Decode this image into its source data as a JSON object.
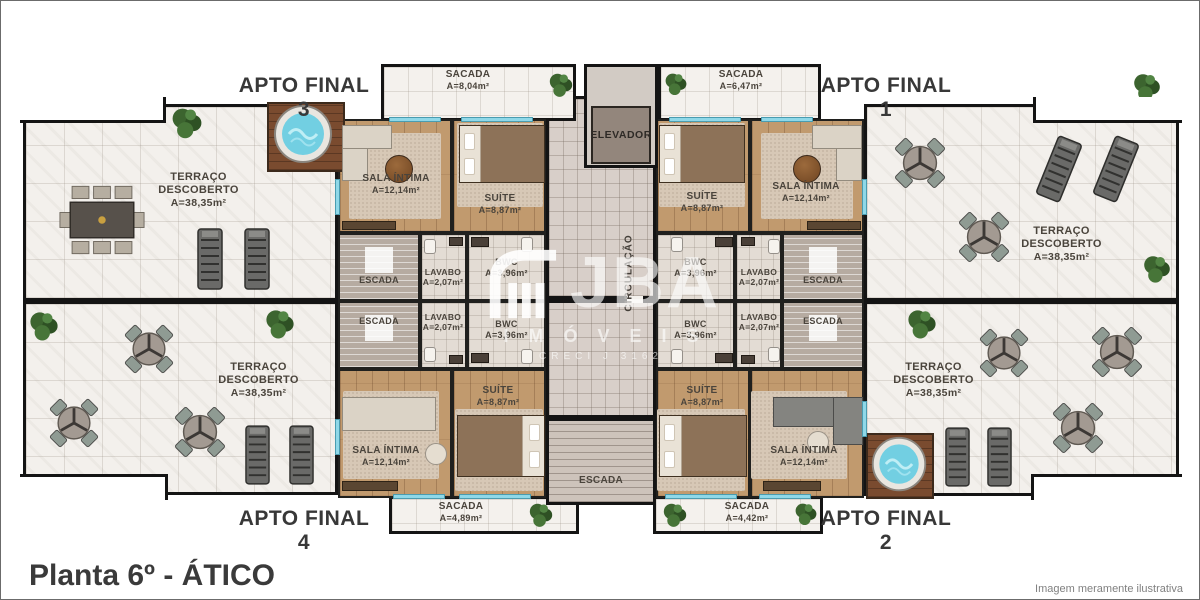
{
  "page": {
    "title": "Planta 6º - ÁTICO",
    "disclaimer": "Imagem meramente ilustrativa"
  },
  "watermark": {
    "brand": "JBA",
    "subtitle": "IMÓVEIS",
    "creci": "CRECI J 3162"
  },
  "core": {
    "elevator": "ELEVADOR",
    "circulation": "CIRCULAÇÃO",
    "central_stairs": "ESCADA"
  },
  "apartments": {
    "apto1": {
      "label": "APTO FINAL 1",
      "sacada": "SACADA",
      "sacada_area": "A=6,47m²",
      "sala": "SALA ÍNTIMA",
      "sala_area": "A=12,14m²",
      "suite": "SUÍTE",
      "suite_area": "A=8,87m²",
      "bwc": "BWC",
      "bwc_area": "A=3,96m²",
      "lavabo": "LAVABO",
      "lavabo_area": "A=2,07m²",
      "escada": "ESCADA",
      "terraco": "TERRAÇO DESCOBERTO",
      "terraco_area": "A=38,35m²"
    },
    "apto2": {
      "label": "APTO FINAL 2",
      "sacada": "SACADA",
      "sacada_area": "A=4,42m²",
      "sala": "SALA ÍNTIMA",
      "sala_area": "A=12,14m²",
      "suite": "SUÍTE",
      "suite_area": "A=8,87m²",
      "bwc": "BWC",
      "bwc_area": "A=3,96m²",
      "lavabo": "LAVABO",
      "lavabo_area": "A=2,07m²",
      "escada": "ESCADA",
      "terraco": "TERRAÇO DESCOBERTO",
      "terraco_area": "A=38,35m²"
    },
    "apto3": {
      "label": "APTO FINAL 3",
      "sacada": "SACADA",
      "sacada_area": "A=8,04m²",
      "sala": "SALA ÍNTIMA",
      "sala_area": "A=12,14m²",
      "suite": "SUÍTE",
      "suite_area": "A=8,87m²",
      "bwc": "BWC",
      "bwc_area": "A=3,96m²",
      "lavabo": "LAVABO",
      "lavabo_area": "A=2,07m²",
      "escada": "ESCADA",
      "terraco": "TERRAÇO DESCOBERTO",
      "terraco_area": "A=38,35m²"
    },
    "apto4": {
      "label": "APTO FINAL 4",
      "sacada": "SACADA",
      "sacada_area": "A=4,89m²",
      "sala": "SALA ÍNTIMA",
      "sala_area": "A=12,14m²",
      "suite": "SUÍTE",
      "suite_area": "A=8,87m²",
      "bwc": "BWC",
      "bwc_area": "A=3,96m²",
      "lavabo": "LAVABO",
      "lavabo_area": "A=2,07m²",
      "escada": "ESCADA",
      "terraco": "TERRAÇO DESCOBERTO",
      "terraco_area": "A=38,35m²"
    }
  },
  "colors": {
    "wall": "#141414",
    "terrace_floor": "#f3f0ec",
    "wood_floor": "#c19a6e",
    "corridor_floor": "#d8cfc9",
    "water": "#72cfe2",
    "plant": "#3c642f"
  }
}
